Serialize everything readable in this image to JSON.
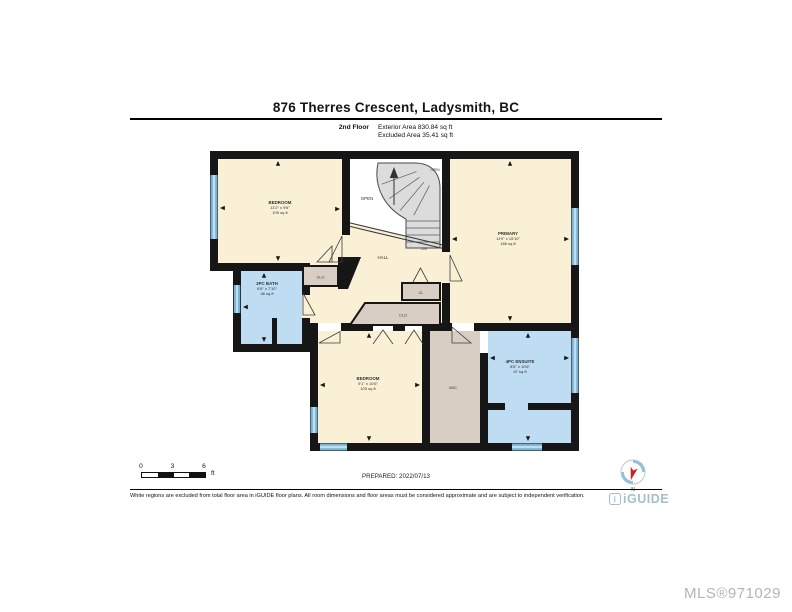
{
  "header": {
    "title": "876 Therres Crescent, Ladysmith, BC",
    "floor_label": "2nd Floor",
    "exterior_area": "Exterior Area 830.84 sq ft",
    "excluded_area": "Excluded Area 35.41 sq ft"
  },
  "floorplan": {
    "rooms": {
      "bedroom1": {
        "name": "BEDROOM",
        "dims": "11'2\" x 9'6\"",
        "area": "109 sq ft"
      },
      "primary": {
        "name": "PRIMARY",
        "dims": "11'9\" x 15'10\"",
        "area": "186 sq ft"
      },
      "bath": {
        "name": "3PC BATH",
        "dims": "6'6\" x 7'10\"",
        "area": "46 sq ft"
      },
      "bedroom2": {
        "name": "BEDROOM",
        "dims": "9'1\" x 10'6\"",
        "area": "103 sq ft"
      },
      "ensuite": {
        "name": "4PC ENSUITE",
        "dims": "8'6\" x 10'6\"",
        "area": "67 sq ft"
      },
      "hall": {
        "name": "HALL"
      },
      "open": {
        "name": "OPEN"
      },
      "open_small": {
        "name": "OPEN"
      },
      "dn": {
        "name": "DN"
      },
      "clo_left": {
        "name": "CLO"
      },
      "cl": {
        "name": "CL"
      },
      "clo_center": {
        "name": "CLO"
      },
      "wic": {
        "name": "WIC"
      }
    },
    "colors": {
      "wall": "#161616",
      "room_cream": "#FAF0D5",
      "room_blue": "#BEDCF2",
      "closet_tan": "#D9CEC3",
      "stairs_gray": "#DCDCDC",
      "window_blue": "#79B2D3",
      "brand_blue": "#A3BECF"
    }
  },
  "footer": {
    "scale": {
      "ticks": [
        "0",
        "3",
        "6"
      ],
      "unit": "ft"
    },
    "prepared": "PREPARED: 2022/07/13",
    "disclaimer": "White regions are excluded from total floor area in iGUIDE floor plans. All room dimensions and floor areas must be considered approximate and are subject to independent verification.",
    "compass_label": "N",
    "brand_mark": "i",
    "brand": "iGUIDE",
    "mls": "MLS®971029"
  }
}
